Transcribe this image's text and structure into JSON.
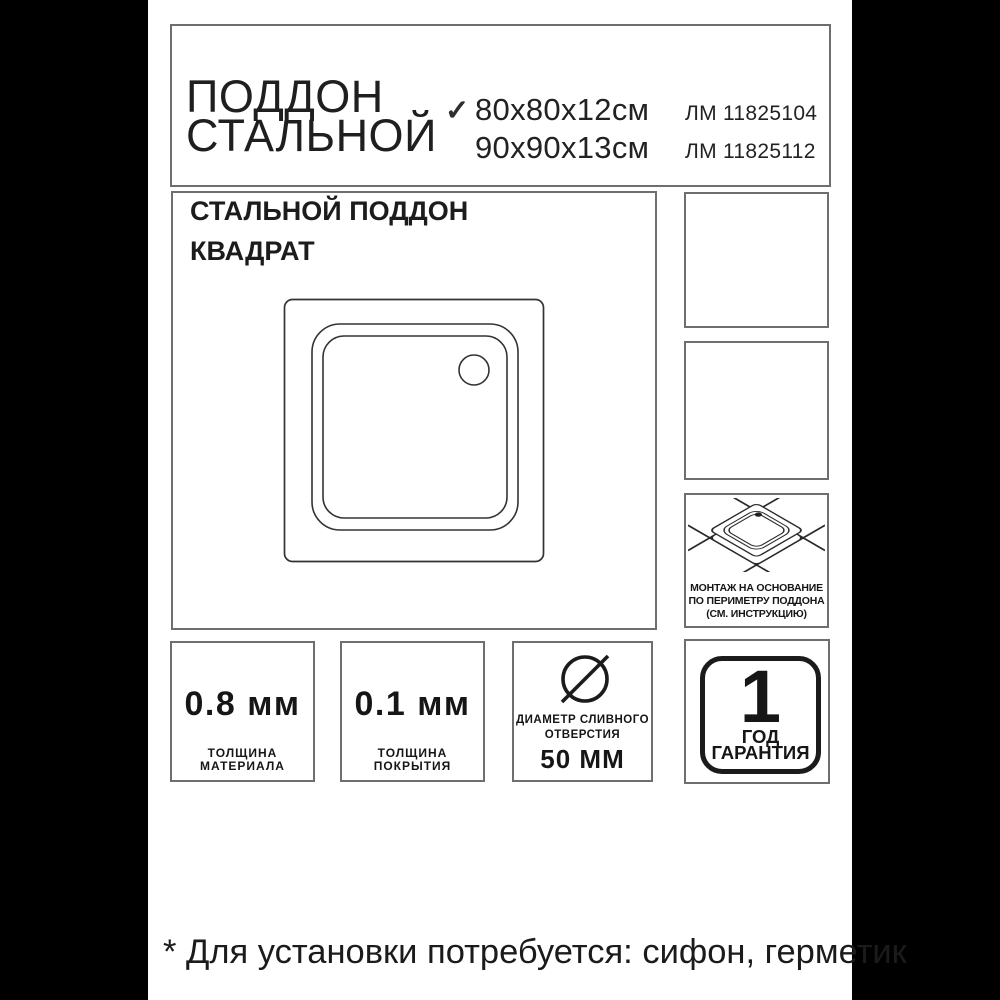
{
  "colors": {
    "side_bar": "#000000",
    "box_border": "#6e6e6e",
    "ink": "#1c1c1c"
  },
  "header": {
    "title_line1": "ПОДДОН",
    "title_line2": "СТАЛЬНОЙ",
    "variants": [
      {
        "check": "✓",
        "size": "80x80x12см",
        "article": "ЛМ 11825104"
      },
      {
        "check": "",
        "size": "90x90x13см",
        "article": "ЛМ 11825112"
      }
    ]
  },
  "main": {
    "heading_line1": "СТАЛЬНОЙ ПОДДОН",
    "heading_line2": "КВАДРАТ"
  },
  "badges": {
    "montage": {
      "lines": [
        "МОНТАЖ НА ОСНОВАНИЕ",
        "ПО ПЕРИМЕТРУ ПОДДОНА",
        "(СМ. ИНСТРУКЦИЮ)"
      ]
    },
    "material": {
      "value": "0.8 мм",
      "label_lines": [
        "ТОЛЩИНА",
        "МАТЕРИАЛА"
      ]
    },
    "coating": {
      "value": "0.1 мм",
      "label_lines": [
        "ТОЛЩИНА",
        "ПОКРЫТИЯ"
      ]
    },
    "drain": {
      "label_lines": [
        "ДИАМЕТР СЛИВНОГО",
        "ОТВЕРСТИЯ"
      ],
      "value": "50 ММ"
    },
    "warranty": {
      "number": "1",
      "label_lines": [
        "ГОД",
        "ГАРАНТИЯ"
      ]
    }
  },
  "footnote": "* Для установки потребуется: сифон, герметик"
}
